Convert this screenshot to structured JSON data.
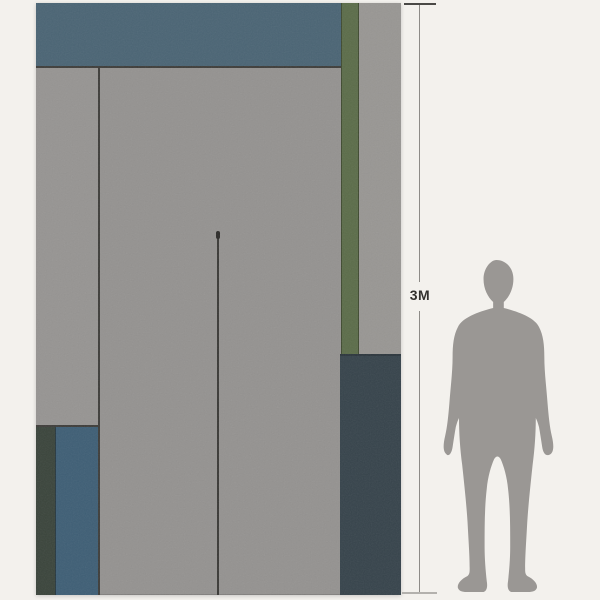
{
  "page": {
    "background": "#f3f1ed"
  },
  "scale_indicator": {
    "label": "3M",
    "line_color": "#8d8b87",
    "top_tick_color": "#4a4946",
    "bottom_tick_color": "#b3b1ad",
    "label_color": "#33312e"
  },
  "artwork": {
    "description": "abstract-geometric-mural-panel",
    "panels": {
      "base_gray": "#949290",
      "top_blue_band": "#4a6474",
      "olive_stripe": "#5b6c49",
      "olive_stripe_edge": "#3f4a30",
      "top_right_gray": "#989693",
      "bottom_right_slate": "#36434b",
      "bottom_right_slate_seam": "#2c363d",
      "bottom_left_dark_green": "#3a443b",
      "bottom_left_blue": "#3e5e75",
      "left_column_gray": "#969492",
      "seam": "#3e3d3a",
      "center_line": "#3a3936",
      "center_line_knob": "#2c2b29"
    }
  },
  "figure": {
    "name": "human-silhouette",
    "color": "#9a9794"
  }
}
